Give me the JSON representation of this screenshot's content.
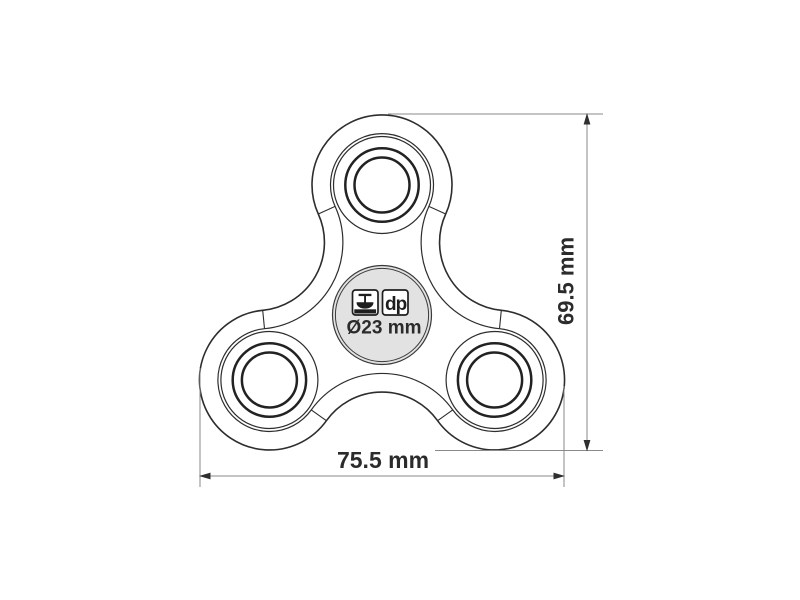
{
  "drawing": {
    "type": "product-technical-drawing",
    "subject": "tri-lobe fidget spinner top view",
    "dimensions": {
      "width_label": "75.5 mm",
      "height_label": "69.5 mm",
      "print_area_label": "Ø23 mm"
    },
    "print_methods": {
      "pad_print_icon": "pad-print-icon",
      "digital_print_label": "dp"
    },
    "colors": {
      "background": "#ffffff",
      "outline": "#2d2d2d",
      "bearing_line": "#222222",
      "dimension_line": "#8a8a8a",
      "arrow": "#2f2f2f",
      "text": "#2b2b2b",
      "print_area_fill": "#e2e2e2"
    }
  }
}
